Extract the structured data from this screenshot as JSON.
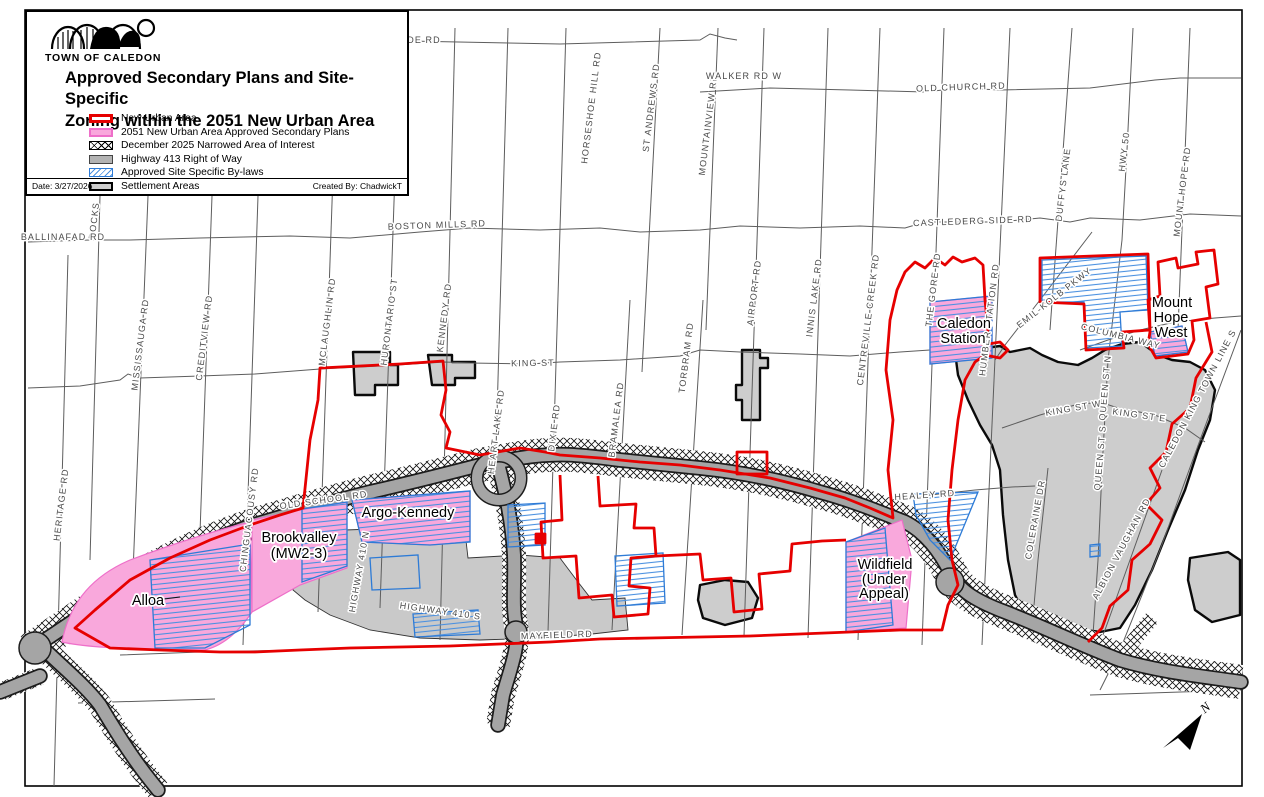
{
  "legend": {
    "logo_text": "TOWN OF CALEDON",
    "title_line1": "Approved Secondary Plans and Site-Specific",
    "title_line2": "Zoning within the 2051 New Urban Area",
    "items": [
      {
        "label": "New Urban Area",
        "swatch": "red-outline"
      },
      {
        "label": "2051 New Urban Area Approved Secondary Plans",
        "swatch": "pink-fill"
      },
      {
        "label": "December 2025 Narrowed Area of Interest",
        "swatch": "black-crosshatch"
      },
      {
        "label": "Highway 413 Right of Way",
        "swatch": "gray-fill"
      },
      {
        "label": "Approved Site Specific By-laws",
        "swatch": "blue-diagonal-hatch"
      },
      {
        "label": "Settlement Areas",
        "swatch": "gray-black-outline"
      }
    ],
    "date_label": "Date: 3/27/2026",
    "created_by": "Created By: ChadwickT"
  },
  "colors": {
    "new_urban_area": "#e60000",
    "secondary_plans_pink": "#f9a8dc",
    "site_specific_blue": "#2e7bd6",
    "highway413_gray": "#a5a5a5",
    "settlement_gray": "#cdcdcd"
  },
  "map": {
    "roads": [
      {
        "t": "HERITAGE RD"
      },
      {
        "t": "ROCKS"
      },
      {
        "t": "MISSISSAUGA RD"
      },
      {
        "t": "CREDITVIEW RD"
      },
      {
        "t": "CHINGUACOUSY RD"
      },
      {
        "t": "MCLAUGHLIN RD"
      },
      {
        "t": "HURONTARIO ST"
      },
      {
        "t": "KENNEDY RD"
      },
      {
        "t": "HEART LAKE RD"
      },
      {
        "t": "DIXIE RD"
      },
      {
        "t": "BRAMALEA RD"
      },
      {
        "t": "HORSESHOE HILL RD"
      },
      {
        "t": "ST ANDREWS RD"
      },
      {
        "t": "MOUNTAINVIEW RD"
      },
      {
        "t": "TORBRAM RD"
      },
      {
        "t": "AIRPORT RD"
      },
      {
        "t": "INNIS LAKE RD"
      },
      {
        "t": "CENTREVILLE CREEK RD"
      },
      {
        "t": "THE GORE RD"
      },
      {
        "t": "HUMBER STATION RD"
      },
      {
        "t": "DUFFYS LANE"
      },
      {
        "t": "HWY 50"
      },
      {
        "t": "MOUNT HOPE RD"
      },
      {
        "t": "EMIL-KOLB PKWY"
      },
      {
        "t": "QUEEN ST N"
      },
      {
        "t": "QUEEN ST S"
      },
      {
        "t": "COLERAINE DR"
      },
      {
        "t": "ALBION VAUGHAN RD"
      },
      {
        "t": "CALEDON KING TOWN LINE S"
      },
      {
        "t": "HIGHWAY 410 N"
      },
      {
        "t": "HIGHWAY 410 S"
      },
      {
        "t": "WALKER RD W"
      },
      {
        "t": "OLD CHURCH RD"
      },
      {
        "t": "BOSTON MILLS RD"
      },
      {
        "t": "CASTLEDERG SIDE RD"
      },
      {
        "t": "BALLINAFAD RD"
      },
      {
        "t": "KING ST"
      },
      {
        "t": "OLD SCHOOL RD"
      },
      {
        "t": "HEALEY RD"
      },
      {
        "t": "MAYFIELD RD"
      },
      {
        "t": "KING ST W"
      },
      {
        "t": "KING ST E"
      },
      {
        "t": "COLUMBIA WAY"
      },
      {
        "t": "DE RD"
      }
    ],
    "areas": [
      "Alloa",
      "Brookvalley",
      "(MW2-3)",
      "Argo-Kennedy",
      "Wildfield",
      "(Under",
      "Appeal)",
      "Caledon",
      "Station",
      "Mount",
      "Hope",
      "West"
    ],
    "north_label": "N"
  }
}
